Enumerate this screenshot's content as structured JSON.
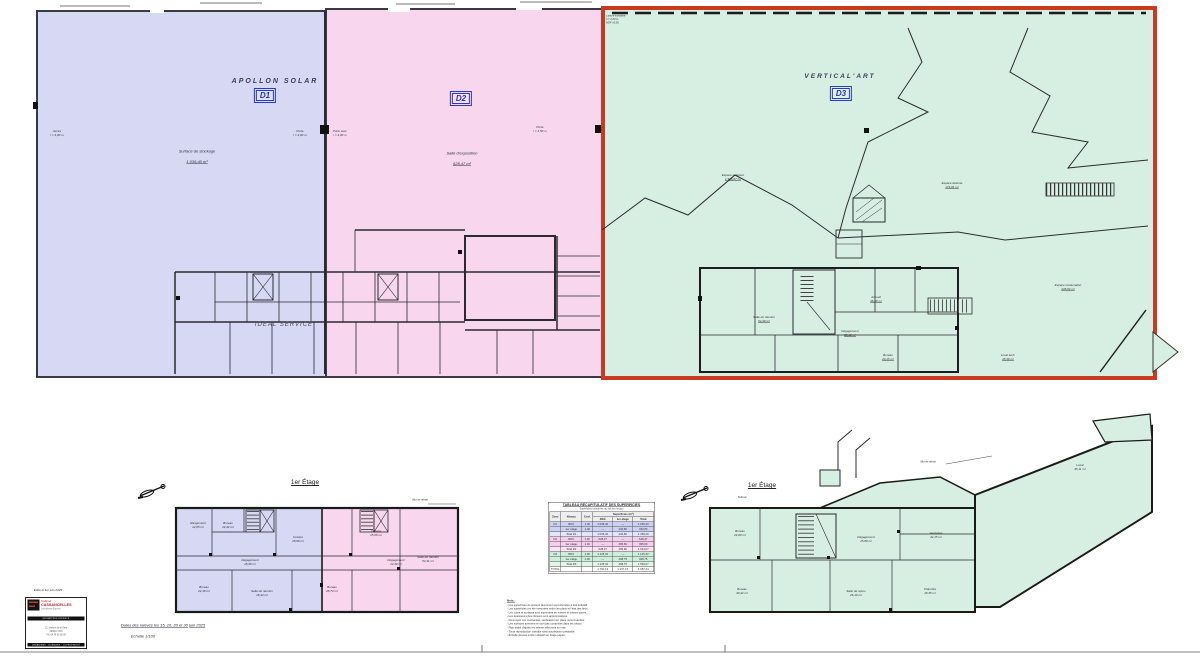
{
  "doc": {
    "edited_note": "Édité le 1er juin 2025",
    "survey_note": "Dates des relevés les 15, 16, 20 et 30 juin 2025",
    "scale": "Échelle 1/100"
  },
  "colors": {
    "d1_fill": "#d6d8f4",
    "d2_fill": "#f8d6ee",
    "d3_fill": "#d7efe2",
    "d3_highlight_border": "#c73b22",
    "tag_blue": "#2233cc",
    "logo_red": "#b22222"
  },
  "zones": {
    "d1": {
      "tag": "D1",
      "company": "APOLLON SOLAR",
      "hall_name": "Surface de stockage",
      "hall_area": "1 036,40 m²"
    },
    "d2": {
      "tag": "D2",
      "hall_name": "Salle d'exposition",
      "hall_area": "628,47 m²"
    },
    "d3": {
      "tag": "D3",
      "company": "VERTICAL'ART",
      "corner_note": "Clôture existante\nh = 2,00 m\nNGF +0,00"
    },
    "ideal_service": "IDEAL SERVICE"
  },
  "gf_annotations": {
    "a1": "Accès\nl = 4,00 m",
    "a2": "Porte\nl = 3,00 m",
    "a3": "Porte sect.\nl = 4,00 m",
    "a4": "Porte\nl = 4,50 m"
  },
  "gf_green_rooms": {
    "ext": {
      "name": "Espace extérieur",
      "area": "1 936,67 m²"
    },
    "det": {
      "name": "Espace détente",
      "area": "174,61 m²"
    },
    "rest": {
      "name": "Espace restauration",
      "area": "248,04 m²"
    },
    "acc": {
      "name": "Accueil",
      "area": "46,80 m²"
    },
    "deg": {
      "name": "Dégagement",
      "area": "38,12 m²"
    },
    "reu": {
      "name": "Salle de réunion",
      "area": "52,40 m²"
    },
    "bur": {
      "name": "Bureau",
      "area": "20,15 m²"
    },
    "tec": {
      "name": "Local tech.",
      "area": "18,30 m²"
    }
  },
  "fl_left": {
    "title": "1er Étage",
    "wall_note": "Mur en retrait",
    "rooms": {
      "l1": "Rangement\n12,05 m²",
      "l2": "Bureau\n14,32 m²",
      "l3": "Cuisine\n18,60 m²",
      "l4": "Bureau\n22,18 m²",
      "l5": "Salle de réunion\n16,44 m²",
      "l6": "Bureau\n28,73 m²",
      "l7": "Cuisine\n15,08 m²",
      "l8": "Salle de réunion\n52,31 m²",
      "l9": "Dégagement\n18,06 m²",
      "l10": "Dégagement\n12,40 m²"
    }
  },
  "fl_right": {
    "title": "1er Étage",
    "wall_note": "Mur en retrait",
    "rooms": {
      "r1": "Bureau\n24,60 m²",
      "r2": "Vestiaires\n32,15 m²",
      "r3": "Bureau\n30,42 m²",
      "r4": "Salle de repos\n26,10 m²",
      "r5": "Chambre\n18,35 m²",
      "r6": "Local\n35,11 m²",
      "r7": "Dégagement\n15,80 m²",
      "r8": "Toiture"
    }
  },
  "table": {
    "title": "TABLEAU RÉCAPITULATIF DES SUPERFICIES",
    "subtitle": "Superficies mesurées au sol des locaux",
    "col_zone": "Zone",
    "col_niveau": "Niveau",
    "col_coef": "Coef.",
    "col_sup": "Superficies (m²)",
    "col_rdc": "RDC",
    "col_1er": "1er étage",
    "col_total": "Total",
    "rows": [
      {
        "band": "blue",
        "cells": [
          "D1",
          "RDC",
          "1,00",
          "1 036,40",
          "—",
          "1 036,40"
        ]
      },
      {
        "band": "blue",
        "cells": [
          "",
          "1er étage",
          "1,00",
          "—",
          "432,80",
          "432,80"
        ]
      },
      {
        "band": "blue-light",
        "cells": [
          "",
          "Total D1",
          "",
          "1 036,40",
          "432,80",
          "1 469,20"
        ]
      },
      {
        "band": "pink",
        "cells": [
          "D2",
          "RDC",
          "1,00",
          "628,47",
          "—",
          "628,47"
        ]
      },
      {
        "band": "pink",
        "cells": [
          "",
          "1er étage",
          "1,00",
          "—",
          "395,60",
          "395,60"
        ]
      },
      {
        "band": "pink-light",
        "cells": [
          "",
          "Total D2",
          "",
          "628,47",
          "395,60",
          "1 024,07"
        ]
      },
      {
        "band": "green",
        "cells": [
          "D3",
          "RDC",
          "1,00",
          "1 125,32",
          "—",
          "1 125,32"
        ]
      },
      {
        "band": "green",
        "cells": [
          "",
          "1er étage",
          "1,00",
          "—",
          "468,75",
          "468,75"
        ]
      },
      {
        "band": "green-light",
        "cells": [
          "",
          "Total D3",
          "",
          "1 125,32",
          "468,75",
          "1 594,07"
        ]
      },
      {
        "band": "total",
        "cells": [
          "TOTAL",
          "",
          "",
          "2 790,19",
          "1 297,15",
          "4 087,34"
        ]
      }
    ]
  },
  "notes": {
    "title": "Nota :",
    "lines": [
      "- Les superficies du présent document sont données à titre indicatif.",
      "- Les superficies ont été mesurées selon les plans et l'état des lieux.",
      "- Les cotes et surfaces sont exprimées en mètres et mètres carrés.",
      "- Les épaisseurs des cloisons sont approximatives.",
      "- Document non contractuel, vérification sur place recommandée.",
      "- Les surfaces annexes ne sont pas comprises dans les totaux.",
      "- Plan établi d'après les relevés effectués sur site.",
      "- Toute reproduction interdite sans autorisation préalable.",
      "- Échelle donnée à titre indicatif sur tirage papier."
    ]
  },
  "logo": {
    "line1": "Cabinet",
    "line2": "CASSANCELLES",
    "line3": "Géomètres-Experts",
    "band_top": "GÉOMÈTRES EXPERTS",
    "addr1": "12, avenue de la Gare",
    "addr2": "69000 LYON",
    "addr3": "Tél. 04 78 00 00 00",
    "band_bottom": "URBANISME · BORNAGE · COPROPRIÉTÉ"
  }
}
